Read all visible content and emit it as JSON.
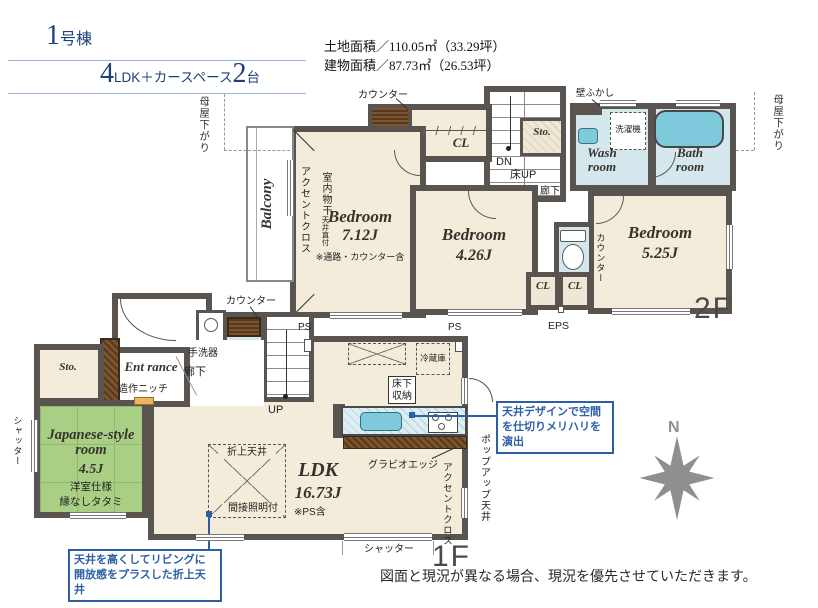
{
  "header": {
    "unit_number": "1",
    "unit_suffix": "号棟",
    "plan_count": "4",
    "plan_text": "LDK＋カースペース",
    "car_count": "2",
    "car_suffix": "台",
    "land_area": "土地面積／110.05㎡（33.29坪）",
    "building_area": "建物面積／87.73㎡（26.53坪）"
  },
  "floor2": {
    "label": "2F",
    "moya_sagari_left": "母屋下がり",
    "moya_sagari_right": "母屋下がり",
    "balcony": "Balcony",
    "accent_cross": "アクセントクロス",
    "indoor_laundry": "室内物干",
    "ceiling_direct": "天井直付",
    "counter": "カウンター",
    "cl": "CL",
    "bedroom1_name": "Bedroom",
    "bedroom1_size": "7.12J",
    "bedroom1_note": "※通路・カウンター含",
    "dn": "DN",
    "floor_up": "床UP",
    "storage": "Sto.",
    "wall_fukashi": "壁ふかし",
    "washer": "洗濯機",
    "wash_room": "Wash room",
    "bath_room": "Bath room",
    "hallway": "廊下",
    "bedroom2_name": "Bedroom",
    "bedroom2_size": "4.26J",
    "side_counter": "カウンター",
    "eps": "EPS",
    "bedroom3_name": "Bedroom",
    "bedroom3_size": "5.25J"
  },
  "floor1": {
    "label": "1F",
    "counter": "カウンター",
    "hand_basin": "手洗器",
    "entrance": "Ent rance",
    "hallway": "廊下",
    "niche": "造作ニッチ",
    "storage": "Sto.",
    "shutter_left": "シャッター",
    "japanese_room_name": "Japanese-style room",
    "japanese_room_size": "4.5J",
    "japanese_room_note1": "洋室仕様",
    "japanese_room_note2": "縁なしタタミ",
    "up": "UP",
    "ps": "PS",
    "fridge": "冷蔵庫",
    "underfloor_storage": "床下収納",
    "ldk_name": "LDK",
    "ldk_size": "16.73J",
    "ldk_note": "※PS含",
    "coffered_ceiling": "折上天井",
    "indirect_light": "間接照明付",
    "gravio_edge": "グラビオエッジ",
    "accent_cross": "アクセントクロス",
    "popup_ceiling": "ポップアップ天井",
    "shutter_bottom": "シャッター"
  },
  "callouts": {
    "kitchen_ceiling": "天井デザインで空間を仕切りメリハリを演出",
    "living_ceiling": "天井を高くしてリビングに開放感をプラスした折上天井"
  },
  "compass": {
    "north": "N"
  },
  "footer": {
    "disclaimer": "図面と現況が異なる場合、現況を優先させていただきます。"
  },
  "colors": {
    "title_navy": "#1e3f77",
    "callout_blue": "#2d5fa7",
    "wall_gray": "#595450",
    "floor_beige": "#f3ecda",
    "water_blue": "#d4e7ec",
    "fixture_blue": "#7fc9dc",
    "tatami_green": "#a9cf85",
    "wood_brown": "#6e4a28",
    "compass_gray": "#8f8f8f"
  }
}
